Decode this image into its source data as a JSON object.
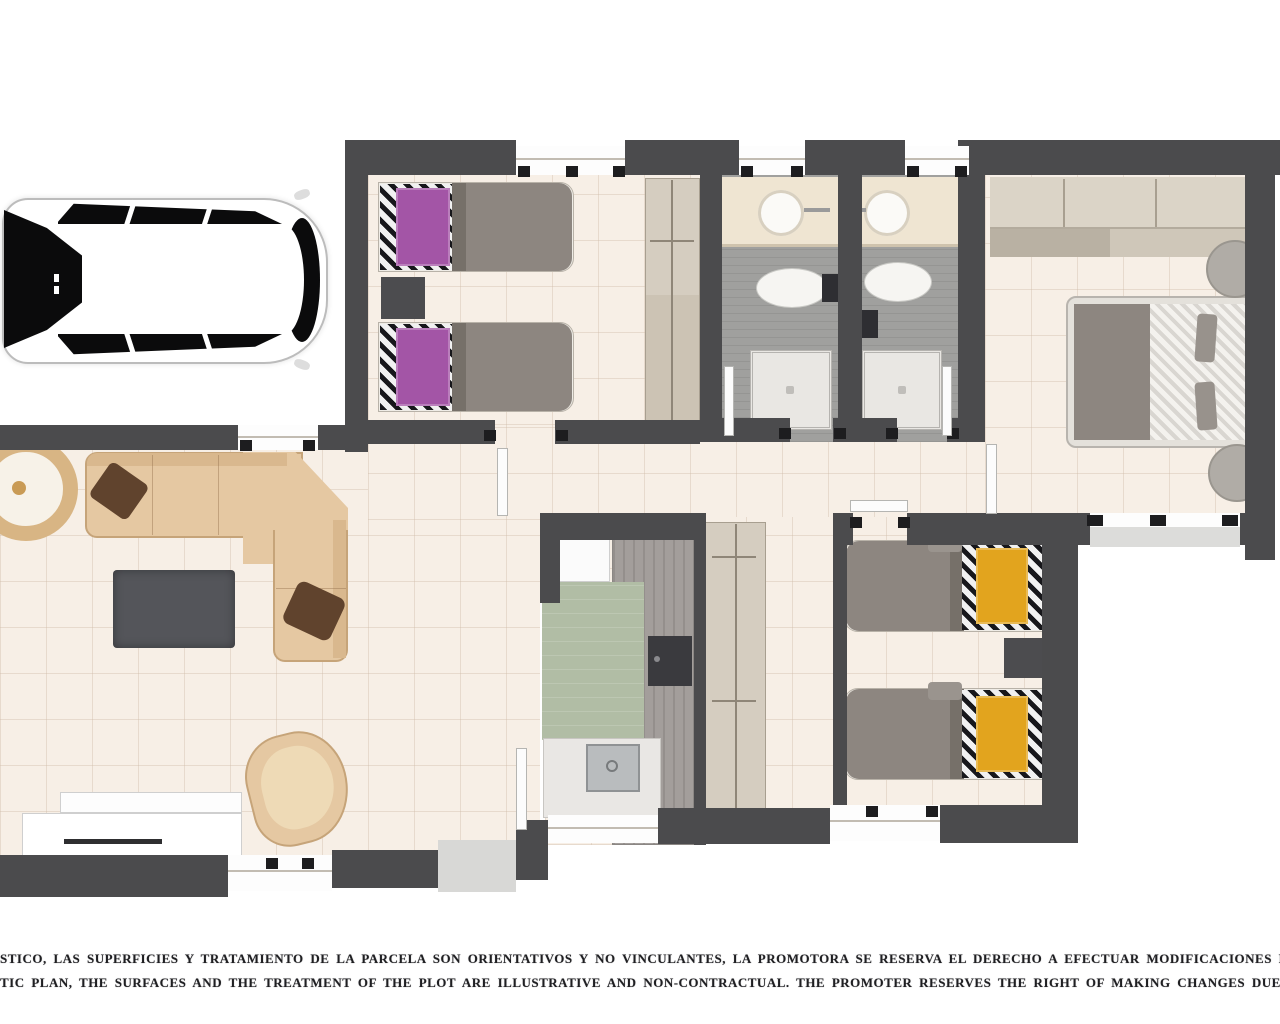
{
  "disclaimer": {
    "line1_es": "STICO, LAS SUPERFICIES Y TRATAMIENTO DE LA PARCELA SON ORIENTATIVOS Y NO VINCULANTES, LA PROMOTORA SE RESERVA EL DERECHO A EFECTUAR MODIFICACIONES POR CUALQ",
    "line2_en": "TIC PLAN, THE SURFACES AND THE TREATMENT OF THE PLOT ARE ILLUSTRATIVE AND NON-CONTRACTUAL. THE PROMOTER RESERVES THE RIGHT OF MAKING CHANGES DUE TO ANY NEC"
  },
  "plan": {
    "type": "residential-floor-plan-top-view",
    "colors": {
      "wall": "#4b4b4d",
      "floor_tile": "#f7efe6",
      "bathroom_tile": "#a0a09e",
      "sofa_beige": "#e5c8a2",
      "pillow_brown": "#60432d",
      "bed_blanket_gray": "#8d8680",
      "bed_accent_purple": "#a355a6",
      "bed_accent_orange": "#e2a41e",
      "duvet_stripe_black": "#17171b",
      "wood_counter": "#a39e9b",
      "cabinet_tan": "#d5cdc0",
      "kitchen_mat_green": "#b1bda5",
      "coffee_table_gray": "#54555a",
      "car_window_black": "#0b0b0c",
      "outside": "#ffffff"
    },
    "elements": [
      "car-top-view",
      "living-room",
      "sofa-l-shaped",
      "coffee-table",
      "armchair",
      "tv-unit",
      "round-rug",
      "bedroom-twin-purple",
      "bedroom-twin-orange",
      "master-bedroom",
      "double-bed",
      "single-bed",
      "nightstand",
      "wardrobe",
      "bathroom",
      "vanity-sink",
      "toilet",
      "shower-tray",
      "kitchen",
      "kitchen-counter",
      "cooktop",
      "kitchen-sink",
      "fridge",
      "hallway-cabinet",
      "porch-step",
      "windows",
      "door-leaves"
    ]
  }
}
